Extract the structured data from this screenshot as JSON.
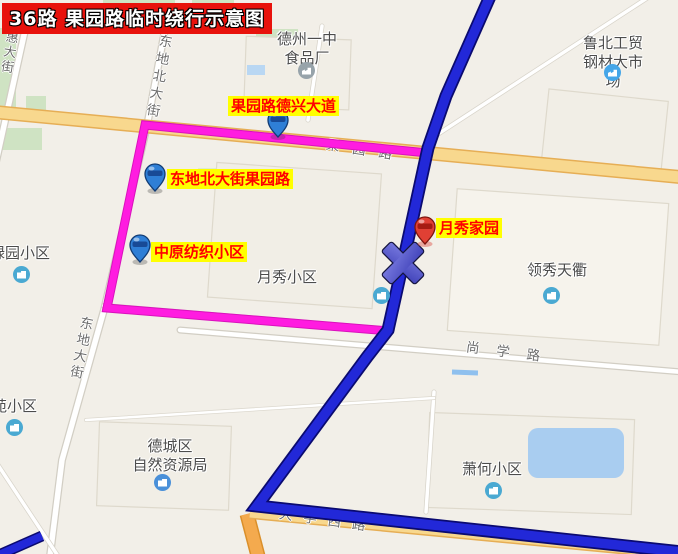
{
  "banner": {
    "title": "36路  果园路临时绕行示意图"
  },
  "highlight_labels": {
    "stop_guoyuan_dexing": "果园路德兴大道",
    "stop_dongdibei_guoyuan": "东地北大街果园路",
    "stop_zhongyuan_fangzhi": "中原纺织小区",
    "place_yuexiu_jiayuan": "月秀家园"
  },
  "roads": {
    "hui_dajie": "惠大街",
    "dongdi_bei_dajie": "东地北大街",
    "dongdi_dajie": "东地大街",
    "guoyuan_lu": "果园路",
    "shangxue_lu": "尚学路",
    "daxue_xi_lu": "大学西路"
  },
  "places": {
    "dezhou_yizhong_shipinchang": "德州一中\n食品厂",
    "lubei_gongmao": "鲁北工贸\n钢材大市场",
    "yuexiu_xiaoqu": "月秀小区",
    "lingxiu_tianqu": "领秀天衢",
    "lvyuan_xiaoqu": "绿园小区",
    "yuan_xiaoqu": "苑小区",
    "decheng_ziran_ziyuanju": "德城区\n自然资源局",
    "xiaohe_xiaoqu": "萧何小区"
  },
  "colors": {
    "map_background": "#f2efe8",
    "regular_route_blue": "#2228d8",
    "detour_route_magenta": "#ff1ce0",
    "closure_x_fill": "#5a5ccf",
    "banner_background": "#e8120c",
    "banner_text": "#ffffff",
    "highlight_background": "#ffff00",
    "highlight_text": "#ff0000",
    "major_road_yellow": "#f8d88e",
    "water_blue": "#a9cdf0",
    "park_green": "#cfe3c3"
  },
  "markers": {
    "blue_stop_pin_count": 3,
    "red_place_pin_count": 1,
    "closure_mark": "X"
  }
}
